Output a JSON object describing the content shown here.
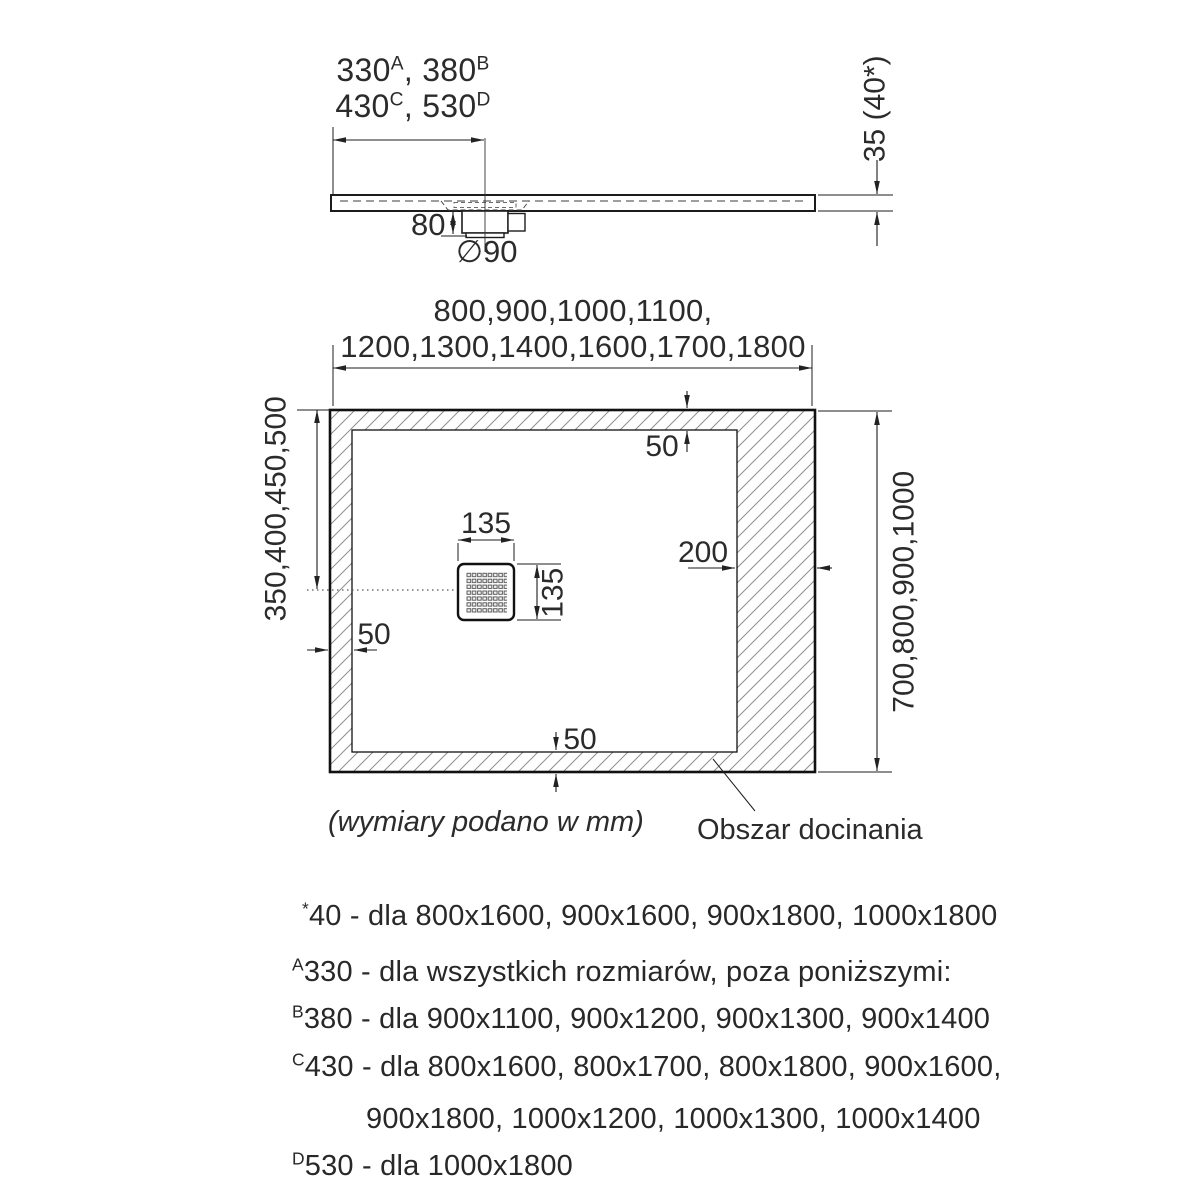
{
  "side_view": {
    "offset_note": {
      "p1": "330",
      "s1": "A",
      "p2": ", 380",
      "s2": "B",
      "p3": "430",
      "s3": "C",
      "p4": ", 530",
      "s4": "D"
    },
    "trap_height": "80",
    "drain_diameter": "∅90",
    "tray_height": "35 (40*)"
  },
  "plan_view": {
    "width_sizes_line1": "800,900,1000,1100,",
    "width_sizes_line2": "1200,1300,1400,1600,1700,1800",
    "offset_sizes": "350,400,450,500",
    "length_sizes": "700,800,900,1000",
    "drain_width": "135",
    "drain_height": "135",
    "margin_top": "50",
    "margin_left": "50",
    "margin_bottom": "50",
    "trim_zone_width": "200",
    "units_note": "(wymiary podano w mm)",
    "trim_zone_label": "Obszar docinania"
  },
  "footnotes": [
    {
      "sup": "*",
      "text": "40 - dla 800x1600, 900x1600, 900x1800, 1000x1800"
    },
    {
      "sup": "A",
      "text": "330 - dla wszystkich rozmiarów, poza poniższymi:"
    },
    {
      "sup": "B",
      "text": "380 - dla 900x1100, 900x1200, 900x1300, 900x1400"
    },
    {
      "sup": "C",
      "text": "430 - dla 800x1600, 800x1700, 800x1800, 900x1600,"
    },
    {
      "sup": "",
      "text": "900x1800, 1000x1200, 1000x1300, 1000x1400"
    },
    {
      "sup": "D",
      "text": "530 - dla 1000x1800"
    }
  ]
}
